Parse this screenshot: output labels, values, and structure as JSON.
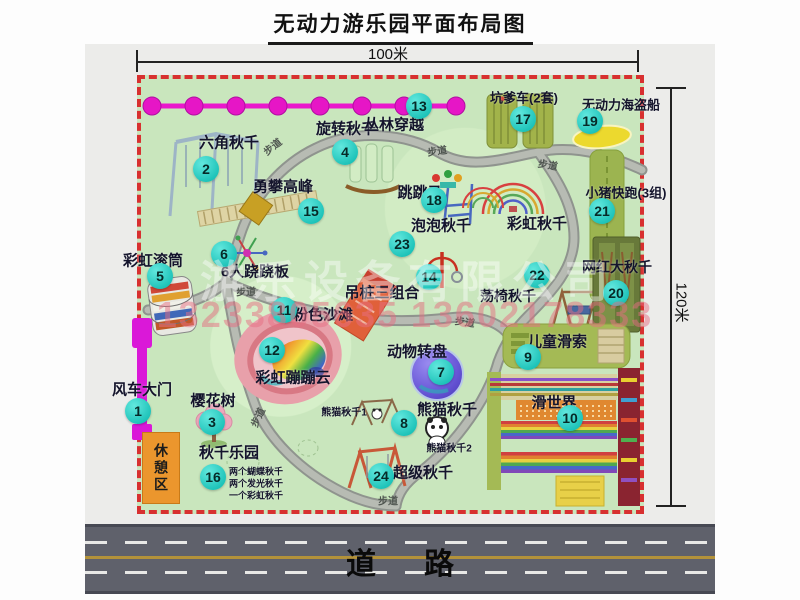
{
  "title": "无动力游乐园平面布局图",
  "dimensions": {
    "top": "100米",
    "right": "120米"
  },
  "road_label": "道路",
  "rest_area_label": "休憩区",
  "path_label_text": "步道",
  "watermark": {
    "company": "游乐设备有限公司",
    "phones": "13233805635 13602178333"
  },
  "colors": {
    "map_green": "#c9e6bd",
    "border_red": "#d83030",
    "badge_teal": "#1cc2b8",
    "road_gray": "#5f616b",
    "gate_magenta": "#da18d8",
    "zipline_magenta": "#ea18cc",
    "rest_orange": "#eb962d"
  },
  "items": [
    {
      "num": "1",
      "label": "风车大门",
      "lx": 142,
      "ly": 389,
      "bx": 138,
      "by": 411,
      "fs": 15
    },
    {
      "num": "2",
      "label": "六角秋千",
      "lx": 229,
      "ly": 142,
      "bx": 206,
      "by": 169,
      "fs": 15
    },
    {
      "num": "3",
      "label": "樱花树",
      "lx": 213,
      "ly": 400,
      "bx": 212,
      "by": 422,
      "fs": 15
    },
    {
      "num": "4",
      "label": "旋转秋千",
      "lx": 346,
      "ly": 128,
      "bx": 345,
      "by": 152,
      "fs": 15
    },
    {
      "num": "5",
      "label": "彩虹滚筒",
      "lx": 153,
      "ly": 260,
      "bx": 160,
      "by": 276,
      "fs": 15
    },
    {
      "num": "6",
      "label": "6人跷跷板",
      "lx": 255,
      "ly": 271,
      "bx": 224,
      "by": 254,
      "fs": 15
    },
    {
      "num": "7",
      "label": "动物转盘",
      "lx": 417,
      "ly": 351,
      "bx": 441,
      "by": 372,
      "fs": 15
    },
    {
      "num": "8",
      "label": "熊猫秋千",
      "lx": 447,
      "ly": 409,
      "bx": 404,
      "by": 423,
      "fs": 15
    },
    {
      "num": "9",
      "label": "儿童滑索",
      "lx": 557,
      "ly": 341,
      "bx": 528,
      "by": 357,
      "fs": 15
    },
    {
      "num": "10",
      "label": "滑世界",
      "lx": 554,
      "ly": 402,
      "bx": 570,
      "by": 418,
      "fs": 15
    },
    {
      "num": "11",
      "label": "粉色沙滩",
      "lx": 323,
      "ly": 314,
      "bx": 284,
      "by": 310,
      "fs": 15
    },
    {
      "num": "12",
      "label": "彩虹蹦蹦云",
      "lx": 293,
      "ly": 377,
      "bx": 272,
      "by": 350,
      "fs": 15
    },
    {
      "num": "13",
      "label": "丛林穿越",
      "lx": 394,
      "ly": 124,
      "bx": 419,
      "by": 106,
      "fs": 15
    },
    {
      "num": "14",
      "label": "吊桩三组合",
      "lx": 382,
      "ly": 292,
      "bx": 429,
      "by": 277,
      "fs": 15
    },
    {
      "num": "15",
      "label": "勇攀高峰",
      "lx": 283,
      "ly": 186,
      "bx": 311,
      "by": 211,
      "fs": 15
    },
    {
      "num": "16",
      "label": "秋千乐园",
      "lx": 229,
      "ly": 452,
      "bx": 213,
      "by": 477,
      "fs": 15
    },
    {
      "num": "17",
      "label": "坑爹车(2套)",
      "lx": 524,
      "ly": 97,
      "bx": 523,
      "by": 119,
      "fs": 13
    },
    {
      "num": "18",
      "label": "跳跳马",
      "lx": 420,
      "ly": 192,
      "bx": 434,
      "by": 200,
      "fs": 15
    },
    {
      "num": "19",
      "label": "无动力海盗船",
      "lx": 621,
      "ly": 104,
      "bx": 590,
      "by": 121,
      "fs": 13
    },
    {
      "num": "20",
      "label": "网红大秋千",
      "lx": 617,
      "ly": 267,
      "bx": 616,
      "by": 293,
      "fs": 14
    },
    {
      "num": "21",
      "label": "小猪快跑(3组)",
      "lx": 626,
      "ly": 192,
      "bx": 602,
      "by": 211,
      "fs": 13
    },
    {
      "num": "22",
      "label": "荡椅秋千",
      "lx": 508,
      "ly": 296,
      "bx": 537,
      "by": 275,
      "fs": 14
    },
    {
      "num": "23",
      "label": "泡泡秋千",
      "lx": 441,
      "ly": 225,
      "bx": 402,
      "by": 244,
      "fs": 15
    },
    {
      "num": "24",
      "label": "超级秋千",
      "lx": 423,
      "ly": 472,
      "bx": 381,
      "by": 476,
      "fs": 15
    }
  ],
  "extra_labels": [
    {
      "text": "彩虹秋千",
      "x": 537,
      "y": 223,
      "fs": 15
    },
    {
      "text": "熊猫秋千1",
      "x": 344,
      "y": 411,
      "fs": 10
    },
    {
      "text": "熊猫秋千2",
      "x": 449,
      "y": 447,
      "fs": 10
    },
    {
      "text": "两个蝴蝶秋千",
      "x": 256,
      "y": 471,
      "fs": 9
    },
    {
      "text": "两个发光秋千",
      "x": 256,
      "y": 483,
      "fs": 9
    },
    {
      "text": "一个彩虹秋千",
      "x": 256,
      "y": 495,
      "fs": 9
    }
  ],
  "path_labels": [
    {
      "x": 272,
      "y": 146,
      "rot": -38
    },
    {
      "x": 437,
      "y": 150,
      "rot": -8
    },
    {
      "x": 548,
      "y": 164,
      "rot": 10
    },
    {
      "x": 246,
      "y": 291,
      "rot": 0
    },
    {
      "x": 465,
      "y": 321,
      "rot": 8
    },
    {
      "x": 257,
      "y": 417,
      "rot": -65
    },
    {
      "x": 388,
      "y": 500,
      "rot": 0
    }
  ]
}
